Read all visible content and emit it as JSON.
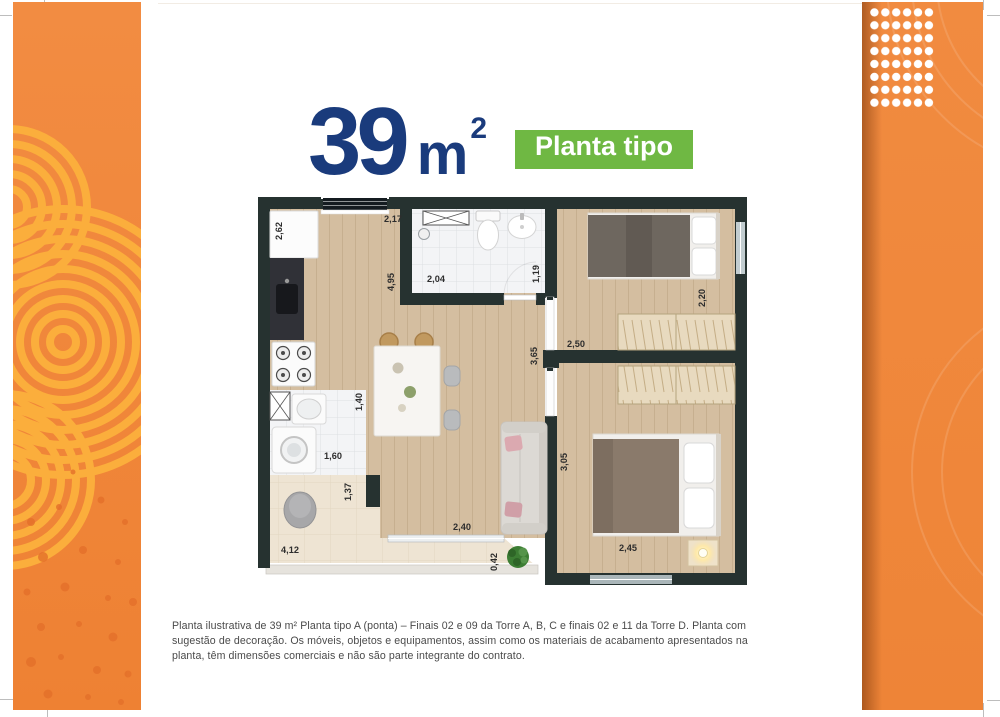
{
  "header": {
    "area_value": "39",
    "area_unit": "m",
    "area_superscript": "2",
    "badge_label": "Planta tipo",
    "title_color": "#1A3B7C",
    "badge_color": "#6FB843"
  },
  "plan": {
    "dims": {
      "refrigerator_wall": "2,62",
      "kitchen_window": "2,17",
      "bathroom_width": "2,04",
      "bathroom_depth": "1,19",
      "kitchen_living_length": "4,95",
      "bedroom1_window_wall": "2,20",
      "bedroom1_width": "2,50",
      "hall_wall": "3,65",
      "laundry_width": "1,40",
      "laundry_length": "1,60",
      "terrace_step_wall": "1,37",
      "bedroom2_length": "3,05",
      "balcony_door": "2,40",
      "terrace_corner": "0,42",
      "bedroom2_width": "2,45",
      "terrace_length": "4,12"
    }
  },
  "footer": {
    "disclaimer": "Planta ilustrativa de 39 m² Planta tipo A (ponta) – Finais 02 e 09 da Torre A, B, C e finais 02 e 11 da Torre D. Planta com sugestão de decoração. Os móveis, objetos e equipamentos, assim como os materiais de acabamento apresentados na planta, têm dimensões comerciais e não são parte integrante do contrato.",
    "disclaimer_color": "#4a4a4a"
  },
  "decor": {
    "panel_orange": "#F0893E",
    "arc_yellow": "#FBAE3C",
    "speckle_orange": "#E4702A",
    "dot_color": "#FFFFFF",
    "wall_color": "#263230"
  }
}
